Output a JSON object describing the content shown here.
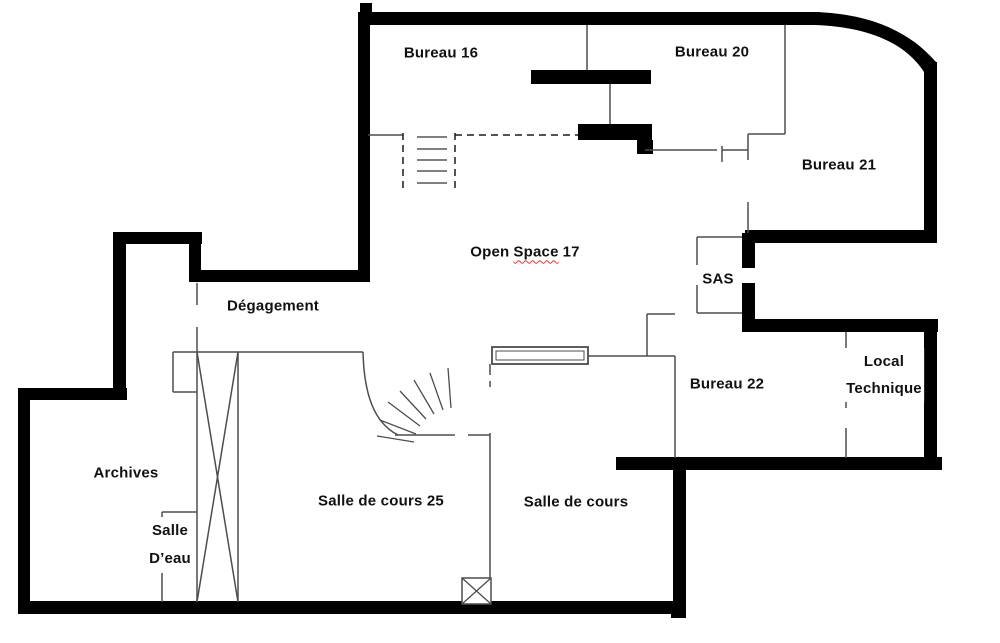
{
  "plan": {
    "rooms": {
      "bureau16": "Bureau 16",
      "bureau20": "Bureau 20",
      "bureau21": "Bureau 21",
      "open_space_a": "Open",
      "open_space_b": "Space",
      "open_space_c": "17",
      "sas": "SAS",
      "degagement": "Dégagement",
      "bureau22": "Bureau 22",
      "local_technique_1": "Local",
      "local_technique_2": "Technique",
      "archives": "Archives",
      "salle_deau_1": "Salle",
      "salle_deau_2": "D’eau",
      "salle_cours25": "Salle de cours 25",
      "salle_cours": "Salle de cours"
    },
    "symbols": {
      "stairs": "stairs-symbol",
      "shaft": "shaft-cross-symbol",
      "door_swing": "door-swing-symbol",
      "window": "window-bay-symbol",
      "column": "column-symbol"
    },
    "colors": {
      "wall": "#000000",
      "partition": "#4d4d4d",
      "tread": "#808080",
      "text": "#111111",
      "misspell_underline": "#ee3333",
      "background": "#ffffff"
    }
  }
}
